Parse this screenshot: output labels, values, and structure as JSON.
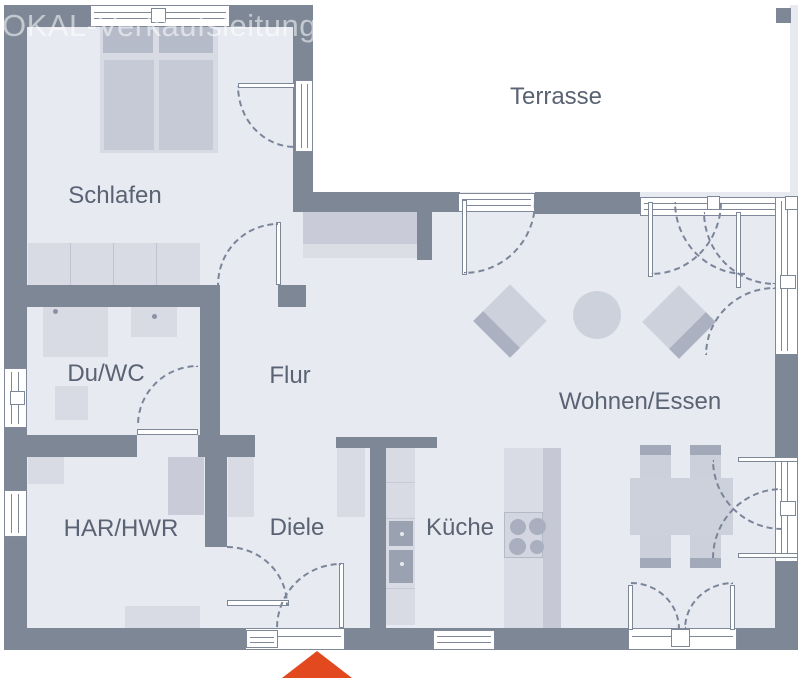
{
  "watermark": "OKAL-Verkaufsleitung Mitte/West",
  "rooms": {
    "terrasse": "Terrasse",
    "schlafen": "Schlafen",
    "du_wc": "Du/WC",
    "flur": "Flur",
    "wohnen_essen": "Wohnen/Essen",
    "har_hwr": "HAR/HWR",
    "diele": "Diele",
    "kueche": "Küche"
  },
  "colors": {
    "wall": "#7d8796",
    "floor": "#e8eaf1",
    "furniture_light": "#d8dbe3",
    "furniture_medium": "#c9ccd8",
    "furniture_dark": "#b5bbc9",
    "appliance": "#9aa1b1",
    "label_text": "#5a6373",
    "watermark_text": "rgba(255,255,255,0.55)",
    "entrance_arrow": "#e2491f",
    "door_swing_line": "#7b8599",
    "window_fill": "#ffffff"
  }
}
